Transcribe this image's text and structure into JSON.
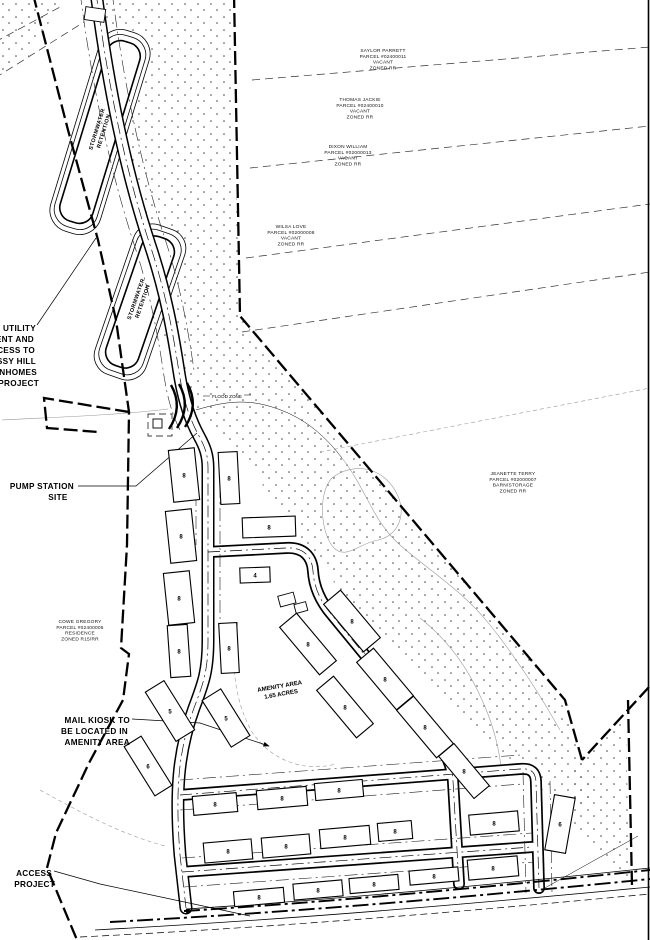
{
  "plan": {
    "ponds": [
      {
        "cx": 100,
        "cy": 130,
        "rot": -73,
        "lines": [
          "STORMWATER",
          "RETENTION"
        ]
      },
      {
        "cx": 139,
        "cy": 300,
        "rot": -71,
        "lines": [
          "STORMWATER",
          "RETENTION"
        ]
      }
    ],
    "parcels": [
      {
        "id": "parcel-saylor",
        "cx": 383,
        "cy": 52,
        "lines": [
          "SAYLOR PARRETT",
          "PARCEL #02400011",
          "VACANT",
          "ZONED RR"
        ]
      },
      {
        "id": "parcel-thomas",
        "cx": 360,
        "cy": 101,
        "lines": [
          "THOMAS JACKIE",
          "PARCEL #02400010",
          "VACANT",
          "ZONED RR"
        ]
      },
      {
        "id": "parcel-dixon",
        "cx": 348,
        "cy": 148,
        "lines": [
          "DIXON WILLIAM",
          "PARCEL #02000013",
          "VACANT",
          "ZONED RR"
        ]
      },
      {
        "id": "parcel-wilsa",
        "cx": 291,
        "cy": 228,
        "lines": [
          "WILSA LOVE",
          "PARCEL #02000008",
          "VACANT",
          "ZONED RR"
        ]
      },
      {
        "id": "parcel-jeanette",
        "cx": 513,
        "cy": 475,
        "lines": [
          "JEANETTE TERRY",
          "PARCEL #02000007",
          "BARN/STORAGE",
          "ZONED RR"
        ]
      },
      {
        "id": "parcel-cowe",
        "cx": 80,
        "cy": 623,
        "lines": [
          "COWE GREGORY",
          "PARCEL #02400005",
          "RESIDENCE",
          "ZONED R15/RR"
        ]
      }
    ],
    "annotations": [
      {
        "id": "utility-easement-note",
        "cls": "anno-t",
        "lines": [
          {
            "t": "UTILITY",
            "x": 36,
            "y": 331,
            "a": "end"
          },
          {
            "t": "ENT AND",
            "x": 34,
            "y": 342,
            "a": "end"
          },
          {
            "t": "CESS TO",
            "x": 35,
            "y": 353,
            "a": "end"
          },
          {
            "t": "SSY HILL",
            "x": 36,
            "y": 364,
            "a": "end"
          },
          {
            "t": "WNHOMES",
            "x": 37,
            "y": 375,
            "a": "end"
          },
          {
            "t": "PROJECT",
            "x": 39,
            "y": 386,
            "a": "end"
          }
        ]
      },
      {
        "id": "pump-station-note",
        "cls": "anno-t",
        "lines": [
          {
            "t": "PUMP STATION",
            "x": 74,
            "y": 489,
            "a": "end"
          },
          {
            "t": "SITE",
            "x": 58,
            "y": 500,
            "a": "middle"
          }
        ]
      },
      {
        "id": "mail-kiosk-note",
        "cls": "anno-t",
        "lines": [
          {
            "t": "MAIL KIOSK TO",
            "x": 130,
            "y": 723,
            "a": "end"
          },
          {
            "t": "BE LOCATED IN",
            "x": 128,
            "y": 734,
            "a": "end"
          },
          {
            "t": "AMENITY AREA",
            "x": 130,
            "y": 745,
            "a": "end"
          }
        ]
      },
      {
        "id": "access-note",
        "cls": "anno-t",
        "lines": [
          {
            "t": "ACCESS",
            "x": 52,
            "y": 876,
            "a": "end"
          },
          {
            "t": "PROJECT",
            "x": 55,
            "y": 887,
            "a": "end"
          }
        ]
      },
      {
        "id": "flood-zone-label",
        "cls": "anno-s",
        "lines": [
          {
            "t": "FLOOD ZONE",
            "x": 227,
            "y": 398,
            "a": "middle"
          }
        ]
      }
    ],
    "amenity_label": {
      "cx": 280,
      "cy": 688,
      "rot": -10,
      "lines": [
        "AMENITY AREA",
        "1.65 ACRES"
      ],
      "lh": 8
    },
    "buildings": [
      {
        "cx": 184,
        "cy": 475,
        "w": 26,
        "h": 52,
        "rot": -6,
        "units": "8"
      },
      {
        "cx": 181,
        "cy": 536,
        "w": 26,
        "h": 52,
        "rot": -6,
        "units": "8"
      },
      {
        "cx": 179,
        "cy": 598,
        "w": 26,
        "h": 52,
        "rot": -6,
        "units": "8"
      },
      {
        "cx": 179,
        "cy": 651,
        "w": 20,
        "h": 52,
        "rot": -4,
        "units": "8"
      },
      {
        "cx": 229,
        "cy": 478,
        "w": 19,
        "h": 52,
        "rot": -3,
        "units": "8"
      },
      {
        "cx": 229,
        "cy": 648,
        "w": 18,
        "h": 50,
        "rot": -3,
        "units": "8"
      },
      {
        "cx": 269,
        "cy": 527,
        "w": 53,
        "h": 20,
        "rot": -2,
        "units": "8"
      },
      {
        "cx": 255,
        "cy": 575,
        "w": 30,
        "h": 15,
        "rot": -2,
        "units": "4"
      },
      {
        "cx": 352,
        "cy": 621,
        "w": 22,
        "h": 62,
        "rot": -40,
        "units": "8"
      },
      {
        "cx": 308,
        "cy": 644,
        "w": 22,
        "h": 62,
        "rot": -40,
        "units": "8"
      },
      {
        "cx": 385,
        "cy": 679,
        "w": 22,
        "h": 62,
        "rot": -40,
        "units": "8"
      },
      {
        "cx": 345,
        "cy": 707,
        "w": 22,
        "h": 62,
        "rot": -40,
        "units": "8"
      },
      {
        "cx": 425,
        "cy": 727,
        "w": 22,
        "h": 62,
        "rot": -40,
        "units": "8"
      },
      {
        "cx": 464,
        "cy": 771,
        "w": 20,
        "h": 55,
        "rot": -40,
        "units": "8"
      },
      {
        "cx": 170,
        "cy": 711,
        "w": 22,
        "h": 58,
        "rot": -32,
        "units": "5"
      },
      {
        "cx": 226,
        "cy": 718,
        "w": 22,
        "h": 55,
        "rot": -32,
        "units": "5"
      },
      {
        "cx": 148,
        "cy": 766,
        "w": 20,
        "h": 58,
        "rot": -32,
        "units": "6"
      },
      {
        "cx": 560,
        "cy": 824,
        "w": 21,
        "h": 56,
        "rot": 10,
        "units": "6"
      },
      {
        "cx": 215,
        "cy": 804,
        "w": 44,
        "h": 19,
        "rot": -5,
        "units": "8"
      },
      {
        "cx": 282,
        "cy": 798,
        "w": 50,
        "h": 19,
        "rot": -5,
        "units": "8"
      },
      {
        "cx": 339,
        "cy": 790,
        "w": 48,
        "h": 17,
        "rot": -5,
        "units": "8"
      },
      {
        "cx": 228,
        "cy": 851,
        "w": 48,
        "h": 20,
        "rot": -5,
        "units": "8"
      },
      {
        "cx": 286,
        "cy": 846,
        "w": 48,
        "h": 20,
        "rot": -5,
        "units": "8"
      },
      {
        "cx": 345,
        "cy": 837,
        "w": 50,
        "h": 19,
        "rot": -5,
        "units": "8"
      },
      {
        "cx": 395,
        "cy": 831,
        "w": 34,
        "h": 18,
        "rot": -5,
        "units": "8"
      },
      {
        "cx": 494,
        "cy": 823,
        "w": 49,
        "h": 20,
        "rot": -5,
        "units": "8"
      },
      {
        "cx": 493,
        "cy": 868,
        "w": 50,
        "h": 20,
        "rot": -5,
        "units": "8"
      },
      {
        "cx": 259,
        "cy": 897,
        "w": 50,
        "h": 15,
        "rot": -5,
        "units": "8"
      },
      {
        "cx": 318,
        "cy": 890,
        "w": 49,
        "h": 16,
        "rot": -5,
        "units": "8"
      },
      {
        "cx": 374,
        "cy": 884,
        "w": 49,
        "h": 15,
        "rot": -5,
        "units": "8"
      },
      {
        "cx": 434,
        "cy": 876,
        "w": 49,
        "h": 14,
        "rot": -5,
        "units": "8"
      }
    ]
  }
}
